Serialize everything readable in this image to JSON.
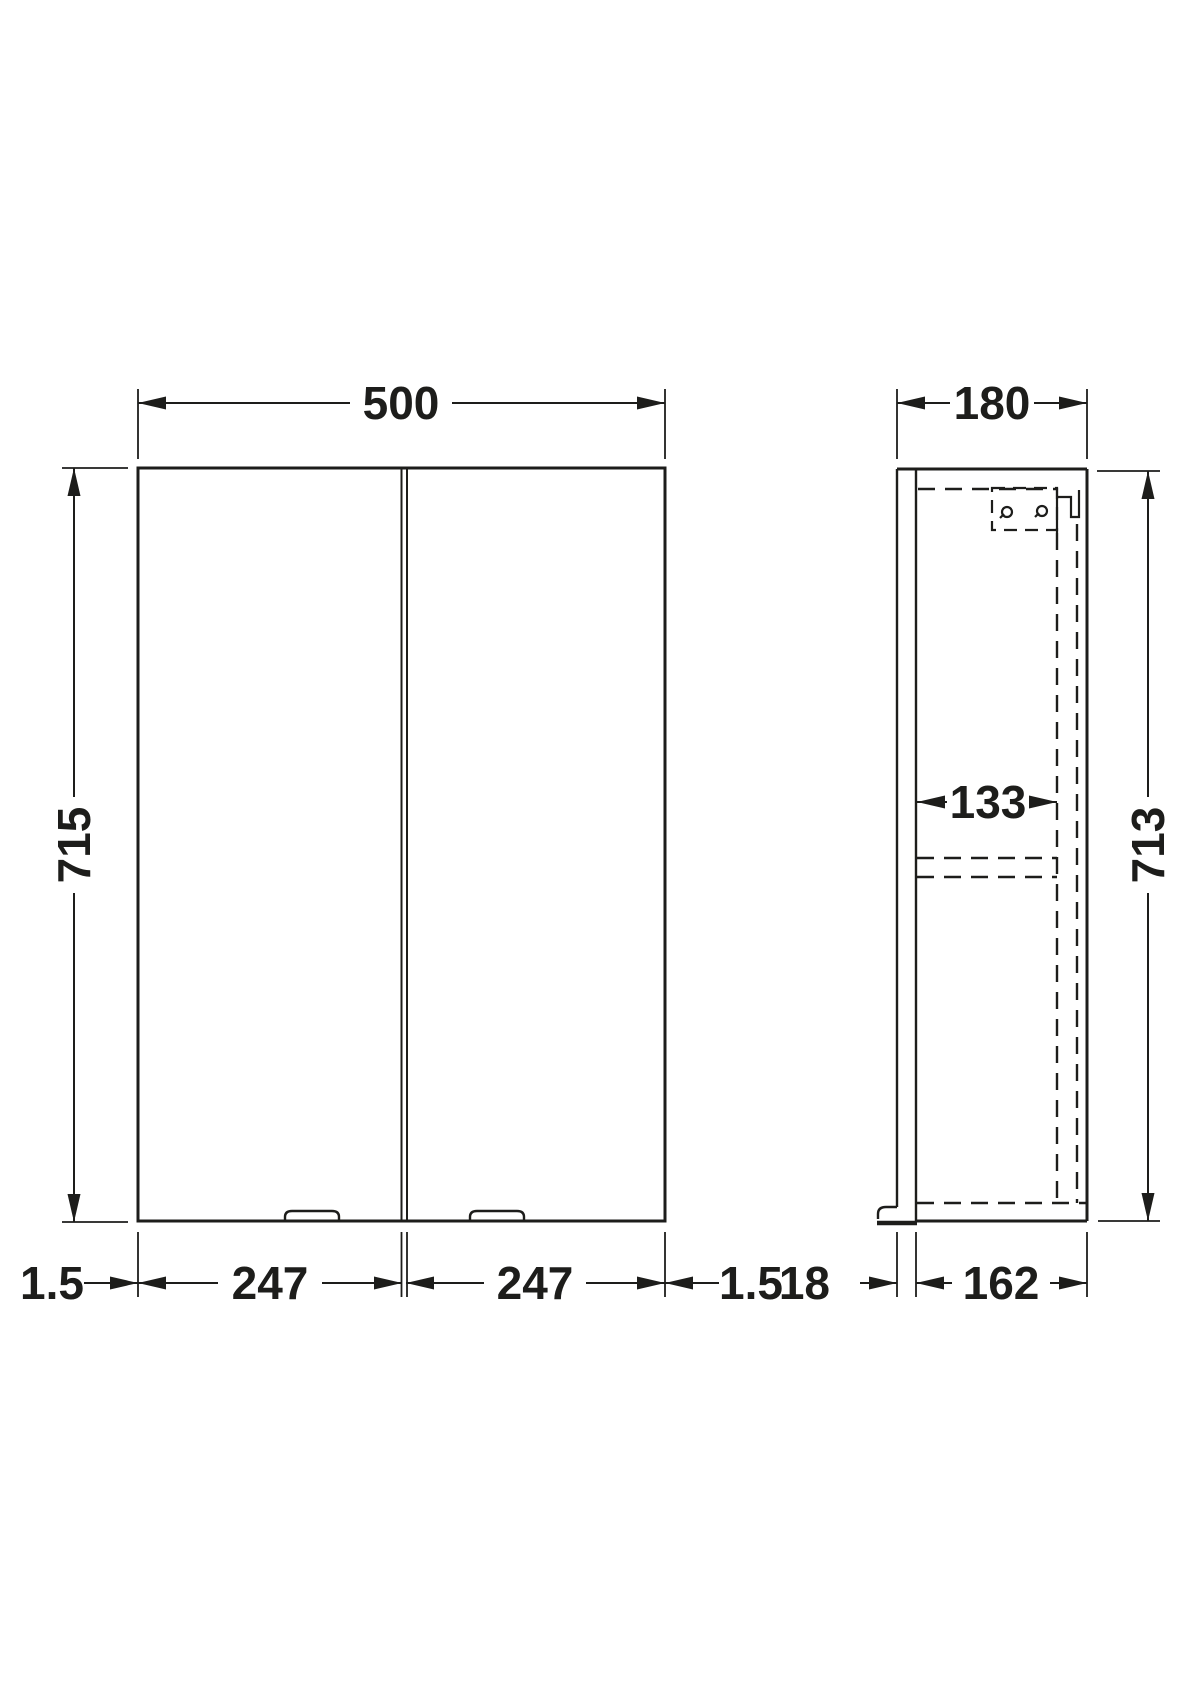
{
  "drawing": {
    "views": {
      "front_view": "front elevation",
      "side_view": "side section"
    }
  },
  "dimensions": {
    "front_view": {
      "overall_width": "500",
      "overall_height": "715",
      "left_gap": "1.5",
      "left_door_width": "247",
      "right_door_width": "247",
      "right_gap": "1.5"
    },
    "side_view": {
      "overall_depth": "180",
      "overall_height": "713",
      "internal_depth": "133",
      "door_thickness": "18",
      "carcass_depth": "162"
    }
  },
  "colors": {
    "line": "#1d1d1b",
    "background": "#ffffff"
  }
}
